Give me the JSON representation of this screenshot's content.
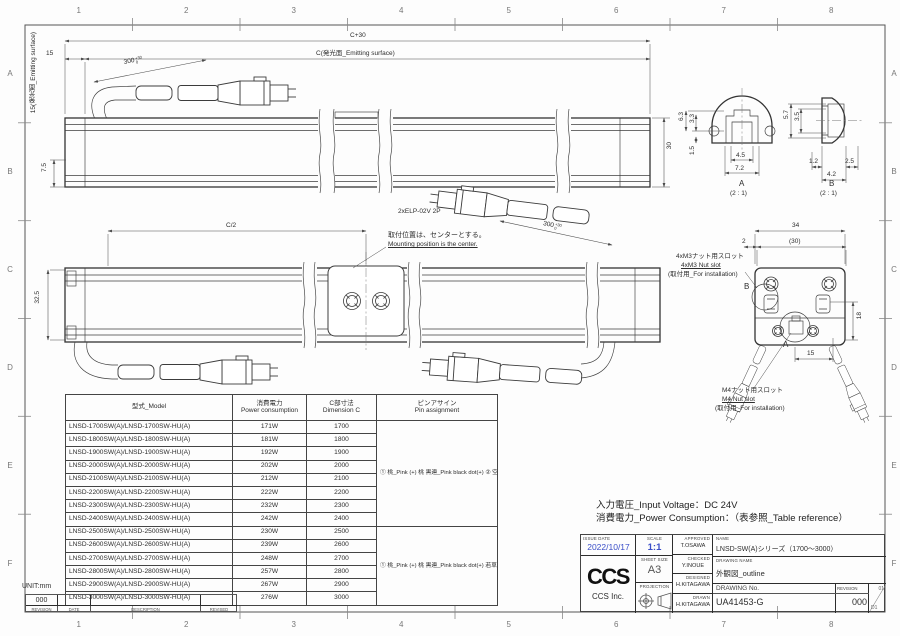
{
  "page": {
    "unit_label": "UNIT:mm",
    "grid_cols": [
      "1",
      "2",
      "3",
      "4",
      "5",
      "6",
      "7",
      "8"
    ],
    "grid_rows": [
      "A",
      "B",
      "C",
      "D",
      "E",
      "F"
    ]
  },
  "colors": {
    "accent_blue": "#3a4ec8",
    "line": "#3c3c3c"
  },
  "dims": {
    "v1_c30": "C+30",
    "v1_c": "C(発光面_Emitting surface)",
    "v1_15": "15",
    "v1_emit": "15(発光面_Emitting surface)",
    "v1_75": "7.5",
    "v1_30": "30",
    "v1_300": "300",
    "tol_hi": "+30",
    "tol_lo": "0",
    "v1_conn": "2xELP-02V 2P",
    "v2_c2": "C/2",
    "v2_325": "32.5",
    "v2_note_jp": "取付位置は、センターとする。",
    "v2_note_en": "Mounting position is the center.",
    "secA_63": "6.3",
    "secA_33": "3.3",
    "secA_15": "1.5",
    "secA_45": "4.5",
    "secA_72": "7.2",
    "secA_lbl": "A",
    "secA_scale": "(2 : 1)",
    "secB_57": "5.7",
    "secB_35": "3.5",
    "secB_12": "1.2",
    "secB_25": "2.5",
    "secB_42": "4.2",
    "secB_lbl": "B",
    "secB_scale": "(2 : 1)",
    "ev_34": "34",
    "ev_2": "2",
    "ev_30p": "(30)",
    "ev_18": "18",
    "ev_15": "15",
    "ev_A": "A",
    "ev_B": "B",
    "ev_m3_jp": "4xM3ナット用スロット",
    "ev_m3_en": "4xM3 Nut slot",
    "ev_m3_note": "(取付用_For installation)",
    "ev_m4_jp": "M4ナット用スロット",
    "ev_m4_en": "M4 Nut slot",
    "ev_m4_note": "(取付用_For installation)"
  },
  "table": {
    "headers": {
      "model": "型式_Model",
      "power_jp": "消費電力",
      "power_en": "Power consumption",
      "dim_jp": "C部寸法",
      "dim_en": "Dimension C",
      "pin_jp": "ピンアサイン",
      "pin_en": "Pin assignment"
    },
    "rows": [
      {
        "model": "LNSD-1700SW(A)/LNSD-1700SW-HU(A)",
        "power": "171W",
        "dim": "1700"
      },
      {
        "model": "LNSD-1800SW(A)/LNSD-1800SW-HU(A)",
        "power": "181W",
        "dim": "1800"
      },
      {
        "model": "LNSD-1900SW(A)/LNSD-1900SW-HU(A)",
        "power": "192W",
        "dim": "1900"
      },
      {
        "model": "LNSD-2000SW(A)/LNSD-2000SW-HU(A)",
        "power": "202W",
        "dim": "2000"
      },
      {
        "model": "LNSD-2100SW(A)/LNSD-2100SW-HU(A)",
        "power": "212W",
        "dim": "2100"
      },
      {
        "model": "LNSD-2200SW(A)/LNSD-2200SW-HU(A)",
        "power": "222W",
        "dim": "2200"
      },
      {
        "model": "LNSD-2300SW(A)/LNSD-2300SW-HU(A)",
        "power": "232W",
        "dim": "2300"
      },
      {
        "model": "LNSD-2400SW(A)/LNSD-2400SW-HU(A)",
        "power": "242W",
        "dim": "2400"
      },
      {
        "model": "LNSD-2500SW(A)/LNSD-2500SW-HU(A)",
        "power": "230W",
        "dim": "2500"
      },
      {
        "model": "LNSD-2600SW(A)/LNSD-2600SW-HU(A)",
        "power": "239W",
        "dim": "2600"
      },
      {
        "model": "LNSD-2700SW(A)/LNSD-2700SW-HU(A)",
        "power": "248W",
        "dim": "2700"
      },
      {
        "model": "LNSD-2800SW(A)/LNSD-2800SW-HU(A)",
        "power": "257W",
        "dim": "2800"
      },
      {
        "model": "LNSD-2900SW(A)/LNSD-2900SW-HU(A)",
        "power": "267W",
        "dim": "2900"
      },
      {
        "model": "LNSD-3000SW(A)/LNSD-3000SW-HU(A)",
        "power": "276W",
        "dim": "3000"
      }
    ],
    "pin_groups": [
      {
        "start": 0,
        "rows": 8,
        "lines": [
          "① 桃_Pink (+)",
          "   桃 黒連_Pink black dot(+)",
          "② 空_Light blue (-)",
          "   空 黒連_Light blue black dot (-)"
        ]
      },
      {
        "start": 8,
        "rows": 6,
        "lines": [
          "① 桃_Pink (+)",
          "   桃 黒連_Pink black dot(+)",
          "   若草_Light green(+)",
          "② 空_Light blue (-)",
          "   空 黒連_Light blue black dot (-)",
          "   若草 黒連_Light green black dot(-)"
        ]
      }
    ]
  },
  "notes": {
    "voltage": "入力電圧_Input Voltage：DC 24V",
    "power_consumption": "消費電力_Power Consumption：（表参照_Table reference）"
  },
  "title_block": {
    "issue_date_label": "ISSUE DATE",
    "issue_date": "2022/10/17",
    "scale_label": "SCALE",
    "scale": "1:1",
    "sheet_size_label": "SHEET  SIZE",
    "sheet_size": "A3",
    "projection_label": "PROJECTION",
    "approved_label": "APPROVED",
    "approved": "T.OSAWA",
    "checked_label": "CHECKED",
    "checked": "Y.INOUE",
    "designed_label": "DESIGNED",
    "designed": "H.KITAGAWA",
    "drawn_label": "DRAWN",
    "drawn": "H.KITAGAWA",
    "name_label": "NAME",
    "name": "LNSD-SW(A)シリーズ（1700～3000）",
    "drawing_name_label": "DRAWING  NAME",
    "drawing_name": "外観図_outline",
    "drawing_no_label": "DRAWING No.",
    "drawing_no": "UA41453-G",
    "revision_label": "REVISION",
    "revision": "000",
    "corner_top": "01",
    "corner_bottom": "D1",
    "logo": "CCS",
    "logo_caption": "CCS Inc."
  },
  "footer": {
    "revision_value": "000",
    "col_labels": [
      "REVISION",
      "DATE",
      "DESCRIPTION",
      "REVISED"
    ]
  }
}
